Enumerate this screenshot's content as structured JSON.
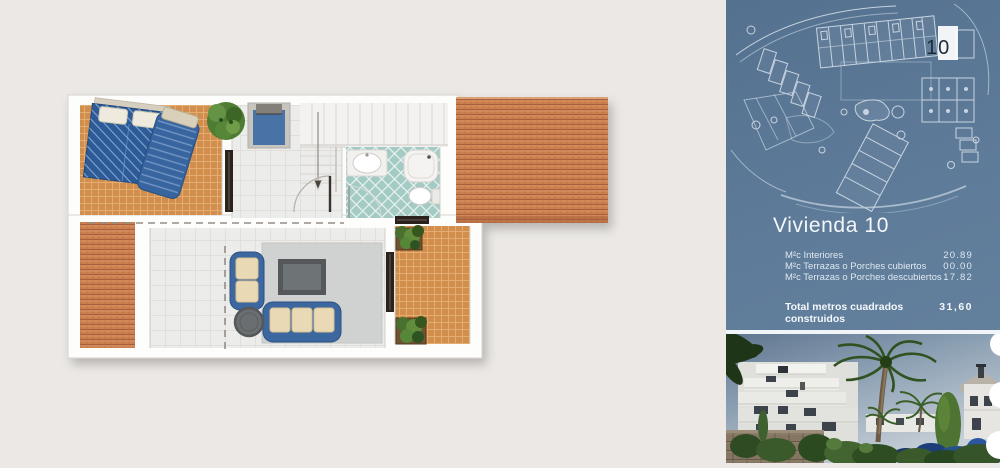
{
  "panel": {
    "site_map": {
      "unit_marker": "10"
    },
    "info": {
      "title": "Vivienda 10",
      "rows": [
        {
          "label": "M²c Interiores",
          "value": "20.89"
        },
        {
          "label": "M²c Terrazas o Porches cubiertos",
          "value": "00.00"
        },
        {
          "label": "M²c Terrazas o Porches descubiertos",
          "value": "17.82"
        }
      ],
      "total": {
        "label": "Total metros cuadrados construidos",
        "value": "31,60"
      }
    }
  },
  "colors": {
    "panel_blue": "#5e7b99",
    "map_line": "#e3ebf3",
    "unit_marker_text": "#1e2b39",
    "terrace_tile": "#d18e4d",
    "roof_tile": "#cc8050",
    "bath_tile": "#a3cac3",
    "furniture_blue": "#3e679f",
    "bed_blue": "#2d5a96",
    "page_background": "#ebe8e5",
    "wall_white": "#fdfdfc",
    "text_white": "#f3f7fa"
  }
}
